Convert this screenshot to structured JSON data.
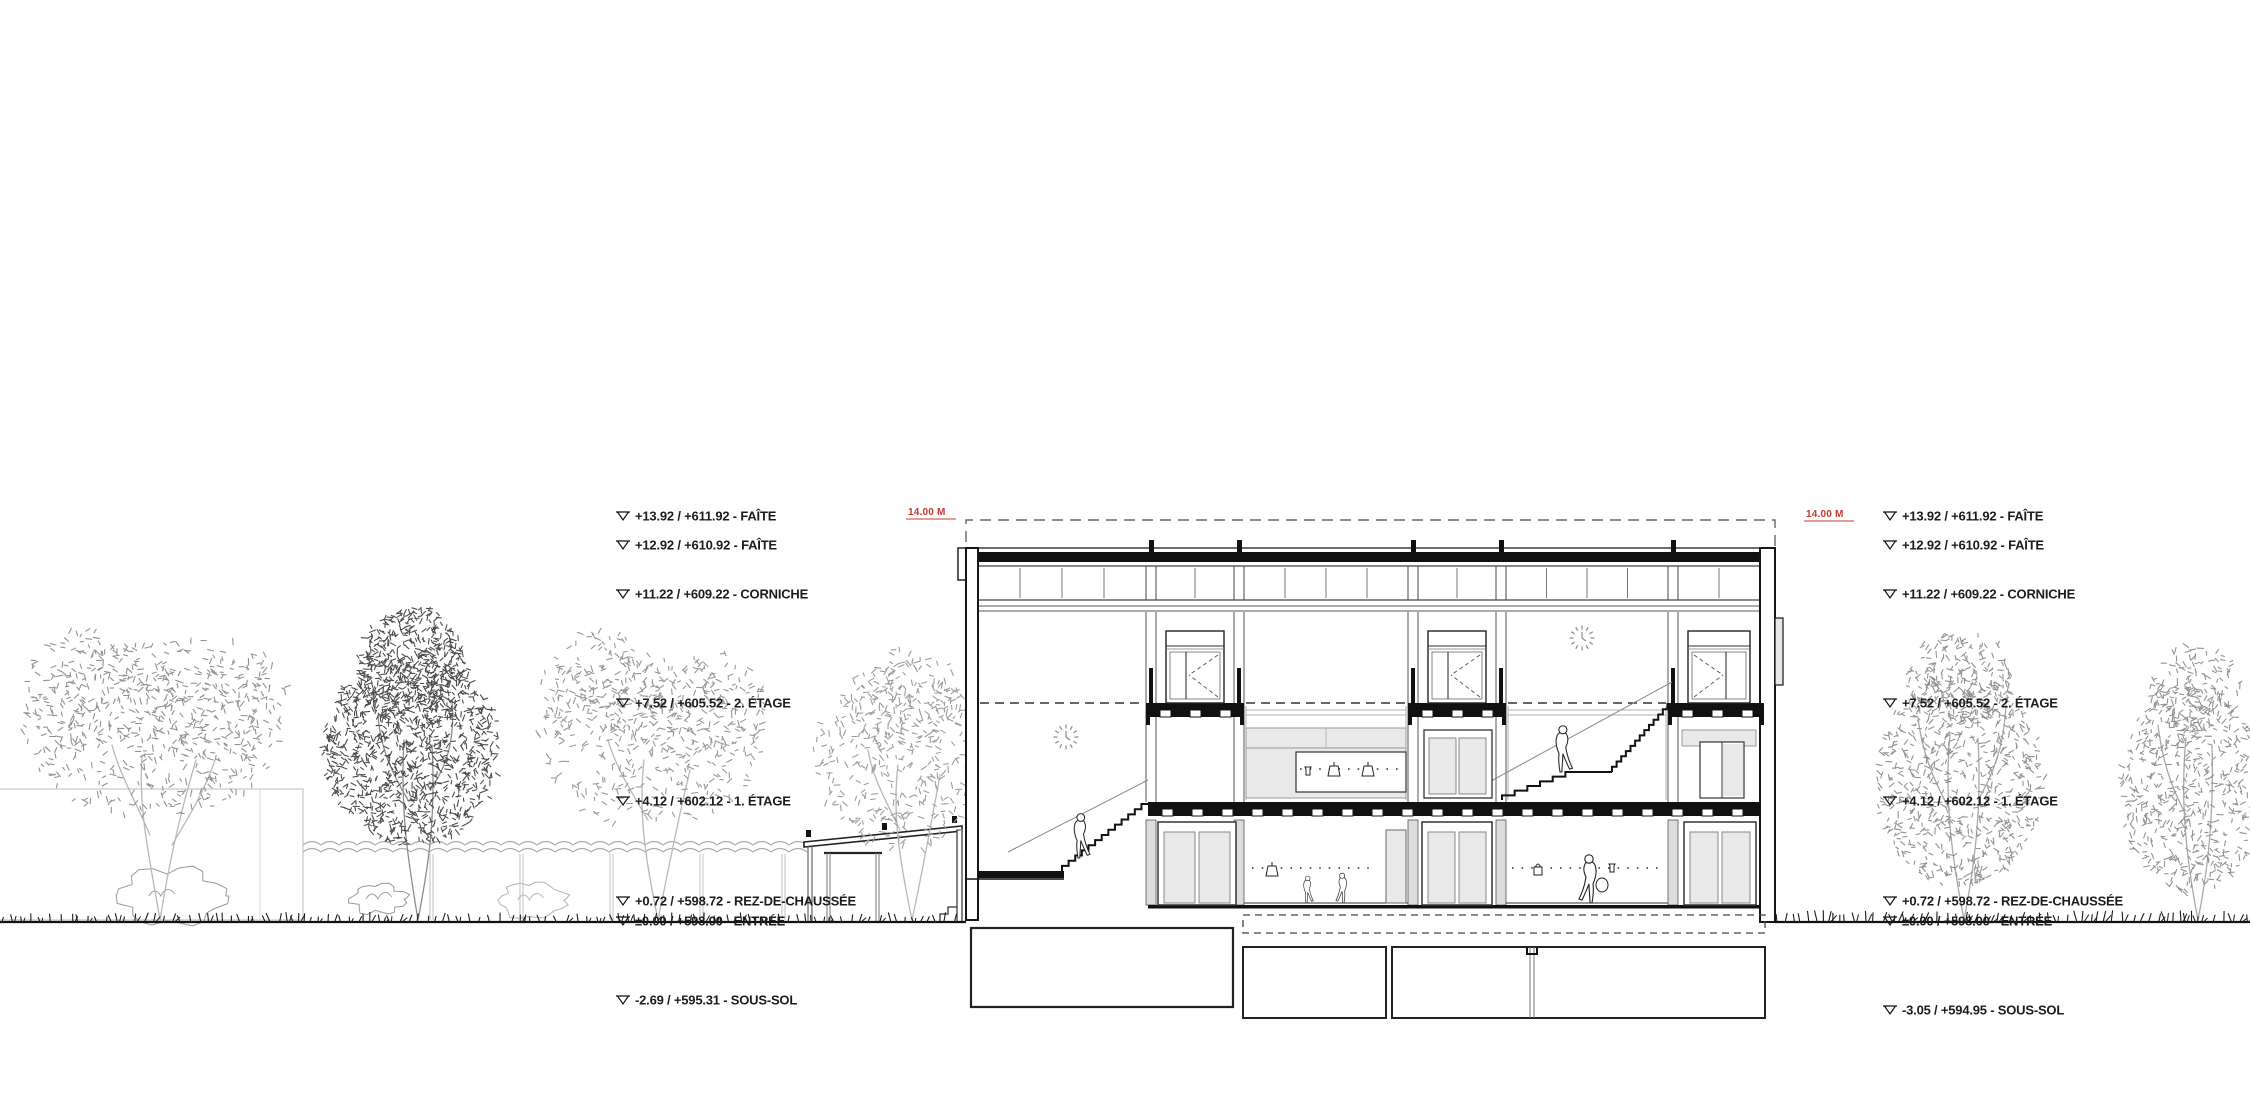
{
  "drawing": {
    "kind": "architectural-cross-section",
    "elevation_labels_left": [
      "+13.92 / +611.92 - FAÎTE",
      "+12.92 / +610.92 - FAÎTE",
      "+11.22 / +609.22 - CORNICHE",
      "+7.52 / +605.52 - 2. ÉTAGE",
      "+4.12 / +602.12 - 1. ÉTAGE",
      "+0.72 / +598.72 - REZ-DE-CHAUSSÉE",
      "±0.00 / +598.00 - ENTRÉE",
      "-2.69 / +595.31 - SOUS-SOL"
    ],
    "elevation_labels_right": [
      "+13.92 / +611.92 - FAÎTE",
      "+12.92 / +610.92 - FAÎTE",
      "+11.22 / +609.22 - CORNICHE",
      "+7.52 / +605.52 - 2. ÉTAGE",
      "+4.12 / +602.12 - 1. ÉTAGE",
      "+0.72 / +598.72 - REZ-DE-CHAUSSÉE",
      "±0.00 / +598.00 - ENTRÉE",
      "-3.05 / +594.95 - SOUS-SOL"
    ],
    "height_dimension": {
      "text": "14.00 M",
      "color": "#c4392e"
    },
    "ink_color": "#161616",
    "glass_fill": "#e9e9e9",
    "foliage_light": "#929292",
    "foliage_dark": "#4c4c4c"
  }
}
